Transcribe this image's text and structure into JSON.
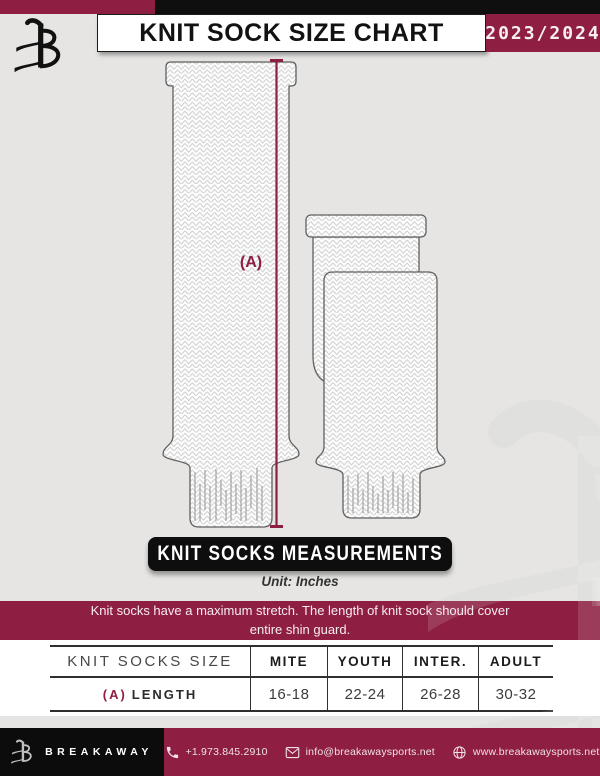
{
  "header": {
    "title": "KNIT SOCK SIZE CHART",
    "season": "2023/2024"
  },
  "diagram": {
    "dimension_label": "(A)",
    "banner_title": "KNIT SOCKS MEASUREMENTS",
    "unit_note": "Unit: Inches",
    "notice": "Knit socks have a maximum stretch. The length of knit sock should cover entire shin guard."
  },
  "table": {
    "columns": [
      "KNIT SOCKS SIZE",
      "MITE",
      "YOUTH",
      "INTER.",
      "ADULT"
    ],
    "rows": [
      {
        "key": "(A)",
        "label": "LENGTH",
        "values": [
          "16-18",
          "22-24",
          "26-28",
          "30-32"
        ]
      }
    ]
  },
  "footer": {
    "brand": "BREAKAWAY",
    "phone": "+1.973.845.2910",
    "email": "info@breakawaysports.net",
    "website": "www.breakawaysports.net"
  },
  "colors": {
    "maroon": "#8E1F43",
    "black": "#0F0F0F",
    "background": "#E6E5E3",
    "watermark": "#DCDCDA"
  }
}
